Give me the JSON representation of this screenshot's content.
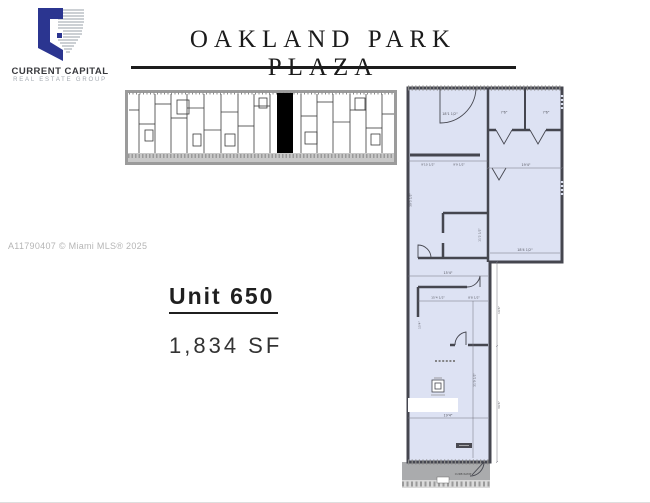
{
  "brand": {
    "name_line1": "CURRENT CAPITAL",
    "name_line2": "REAL ESTATE GROUP"
  },
  "title": "OAKLAND PARK PLAZA",
  "watermark": "A11790407 © Miami MLS® 2025",
  "unit": {
    "label": "Unit 650",
    "area": "1,834 SF"
  },
  "floorplan": {
    "dims": {
      "top_left_room": "18'1 1/2\"",
      "top_right_room_1": "7'6\"",
      "top_right_room_2": "7'6\"",
      "right_room_width_top": "19'4\"",
      "right_room_width_bottom": "18'4 1/2\"",
      "hall_left": "9'10 1/2\"",
      "hall_right": "9'9 1/2\"",
      "middle_room_height": "11'2 1/2\"",
      "lower_width_1": "15'4\"",
      "lower_width_2": "15'4 1/2\"",
      "lower_width_3": "8'8 1/2\"",
      "lower_height": "31'0 1/2\"",
      "bottom_width": "19'4\"",
      "left_height_upper": "30'3 1/2\"",
      "left_height_mid": "15'4\"",
      "right_height_upper": "16'6\"",
      "right_height_lower": "36'6\""
    },
    "labels": {
      "curb": "CURB RAMP"
    }
  },
  "colors": {
    "logo_navy": "#2b3590",
    "plan_fill": "#dde2f3",
    "wall": "#45464f",
    "overview_highlight": "#000000",
    "sidewalk_gray": "#aaabad",
    "title_ink": "#1b1b1b",
    "watermark_gray": "#b5b5b5"
  }
}
